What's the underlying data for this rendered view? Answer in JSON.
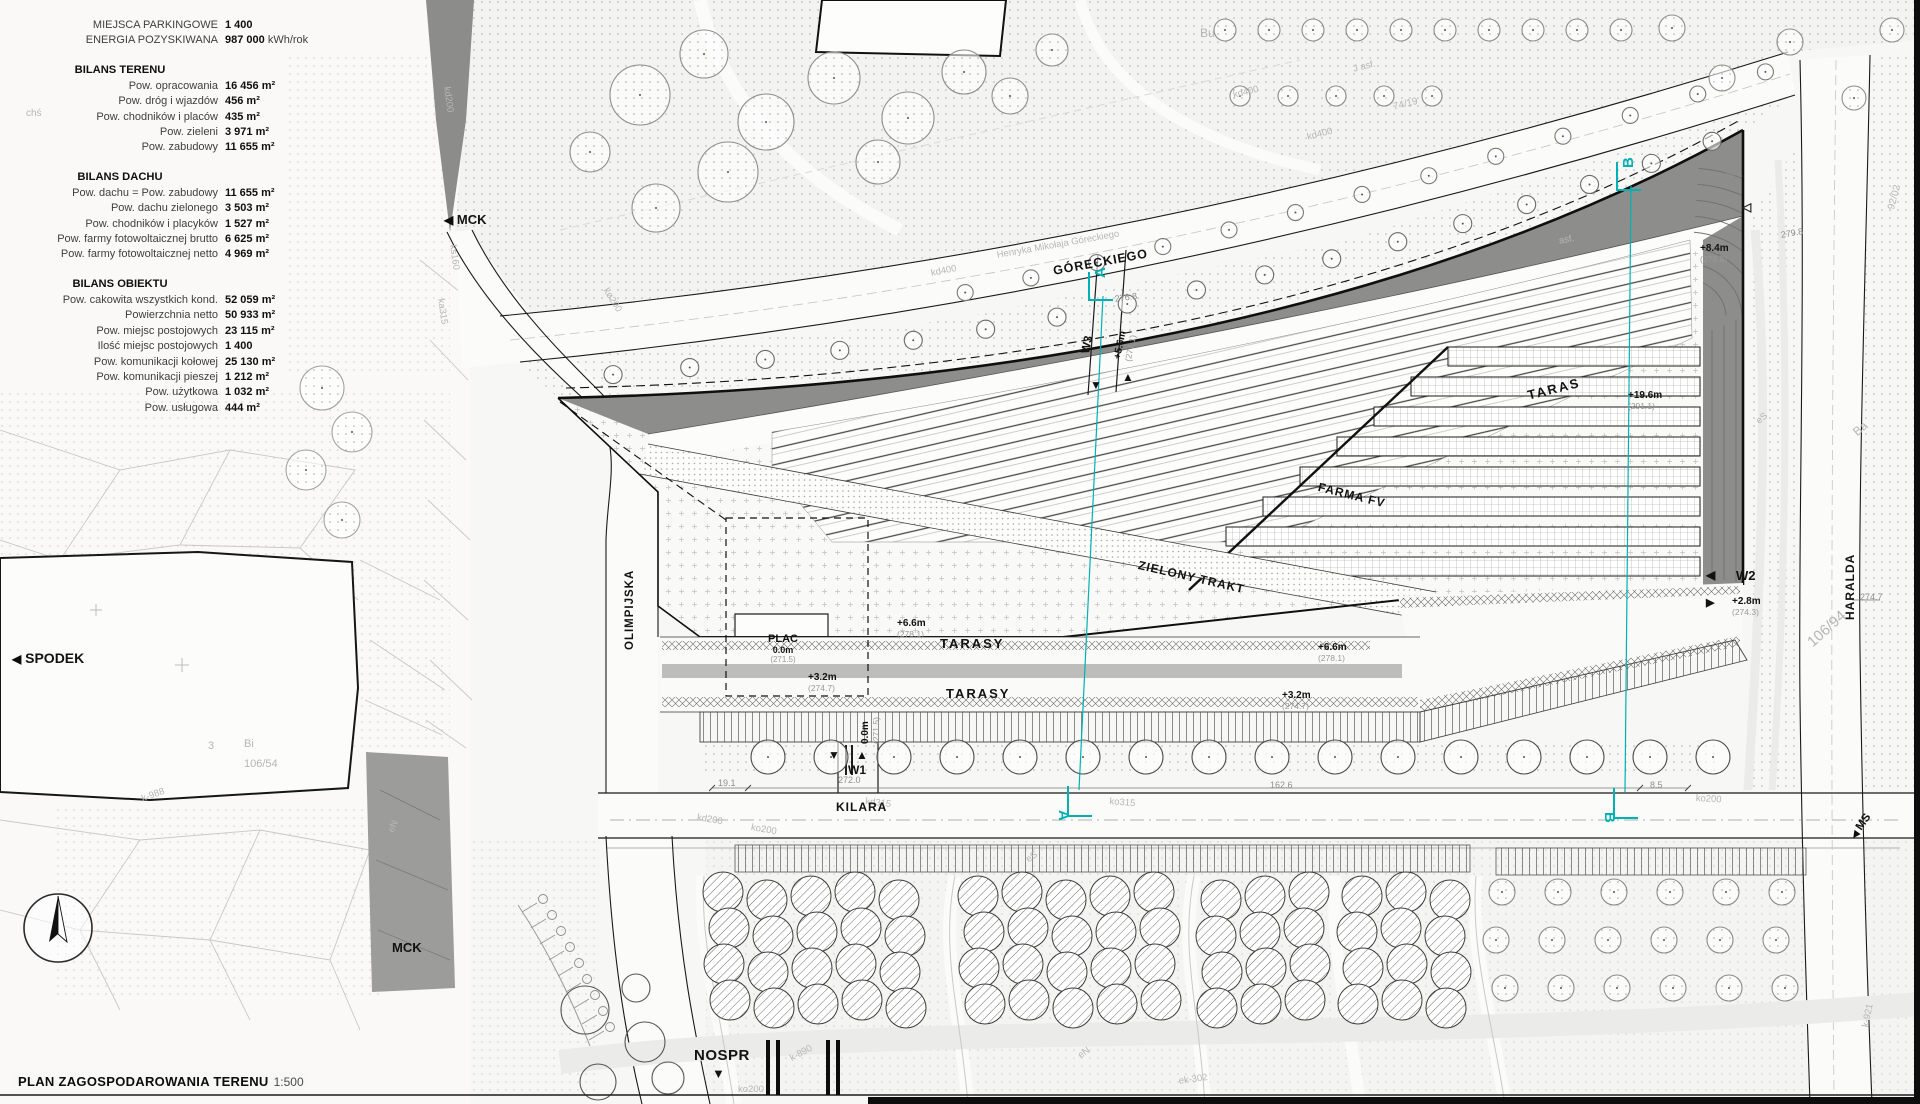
{
  "title": {
    "main": "PLAN ZAGOSPODAROWANIA TERENU",
    "scale": "1:500"
  },
  "stats": {
    "top_rows": [
      {
        "label": "MIEJSCA PARKINGOWE",
        "value": "1 400",
        "unit": ""
      },
      {
        "label": "ENERGIA POZYSKIWANA",
        "value": "987 000",
        "unit": " kWh/rok"
      }
    ],
    "sections": [
      {
        "title": "BILANS TERENU",
        "rows": [
          {
            "label": "Pow. opracowania",
            "value": "16 456 m²"
          },
          {
            "label": "Pow. dróg i wjazdów",
            "value": "456 m²"
          },
          {
            "label": "Pow. chodników i placów",
            "value": "435 m²"
          },
          {
            "label": "Pow. zieleni",
            "value": "3 971 m²"
          },
          {
            "label": "Pow. zabudowy",
            "value": "11 655 m²"
          }
        ]
      },
      {
        "title": "BILANS DACHU",
        "rows": [
          {
            "label": "Pow. dachu = Pow. zabudowy",
            "value": "11 655 m²"
          },
          {
            "label": "Pow. dachu zielonego",
            "value": "3 503 m²"
          },
          {
            "label": "Pow. chodników i placyków",
            "value": "1 527 m²"
          },
          {
            "label": "Pow. farmy fotowoltaicznej brutto",
            "value": "6 625 m²"
          },
          {
            "label": "Pow. farmy fotowoltaicznej netto",
            "value": "4 969 m²"
          }
        ]
      },
      {
        "title": "BILANS OBIEKTU",
        "rows": [
          {
            "label": "Pow. cakowita wszystkich kond.",
            "value": "52 059 m²"
          },
          {
            "label": "Powierzchnia netto",
            "value": "50 933 m²"
          },
          {
            "label": "Pow. miejsc postojowych",
            "value": "23 115 m²"
          },
          {
            "label": "Ilość miejsc postojowych",
            "value": "1 400"
          },
          {
            "label": "Pow. komunikacji kołowej",
            "value": "25 130 m²"
          },
          {
            "label": "Pow. komunikacji pieszej",
            "value": "1 212 m²"
          },
          {
            "label": "Pow. użytkowa",
            "value": "1 032 m²"
          },
          {
            "label": "Pow. usługowa",
            "value": "444 m²"
          }
        ]
      }
    ]
  },
  "landmarks": {
    "mck_top": "MCK",
    "spodek": "SPODEK",
    "mck_bottom": "MCK",
    "nospr": "NOSPR",
    "ms": "MS"
  },
  "streets": {
    "olimpijska": "OLIMPIJSKA",
    "kilara": "KILARA",
    "goreckiego": "GÓRECKIEGO",
    "haralda": "HARALDA",
    "goreckiego_full": "Henryka Mikołaja Góreckiego"
  },
  "zones": {
    "plac": "PLAC",
    "plac_level": "0.0m",
    "plac_abs": "(271.5)",
    "tarasy_upper": "TARASY",
    "tarasy_lower": "TARASY",
    "taras": "TARAS",
    "farma_fv": "FARMA FV",
    "zielony_trakt": "ZIELONY TRAKT"
  },
  "crossings": {
    "w1": "W1",
    "w2": "W2",
    "w3": "W3"
  },
  "section_marks": {
    "a": "A",
    "b": "B"
  },
  "elevations": [
    {
      "id": "w3",
      "level": "+5.6m",
      "abs": "(277.1)"
    },
    {
      "id": "e84",
      "level": "+8.4m",
      "abs": "(279.9)"
    },
    {
      "id": "e196",
      "level": "+19.6m",
      "abs": "(291.1)"
    },
    {
      "id": "e66l",
      "level": "+6.6m",
      "abs": "(278.1)"
    },
    {
      "id": "e66r",
      "level": "+6.6m",
      "abs": "(278.1)"
    },
    {
      "id": "e32l",
      "level": "+3.2m",
      "abs": "(274.7)"
    },
    {
      "id": "e32r",
      "level": "+3.2m",
      "abs": "(274.7)"
    },
    {
      "id": "e28",
      "level": "+2.8m",
      "abs": "(274.3)"
    },
    {
      "id": "w1",
      "level": "0.0m",
      "abs": "(271.5)"
    }
  ],
  "dim_texts": [
    {
      "t": "19.1",
      "x": 718,
      "y": 778,
      "r": 0
    },
    {
      "t": "272.0",
      "x": 838,
      "y": 775,
      "r": 0
    },
    {
      "t": "162.6",
      "x": 1270,
      "y": 780,
      "r": 0
    },
    {
      "t": "8.5",
      "x": 1650,
      "y": 780,
      "r": 0
    },
    {
      "t": "274.7",
      "x": 1860,
      "y": 592,
      "r": 0
    },
    {
      "t": "276.8",
      "x": 1114,
      "y": 294,
      "r": -8
    },
    {
      "t": "279.8",
      "x": 1780,
      "y": 230,
      "r": -10
    },
    {
      "t": "76.2",
      "x": 1724,
      "y": 172,
      "r": -12
    }
  ],
  "background_texts": [
    {
      "t": "kd400",
      "x": 1232,
      "y": 90,
      "r": -14,
      "s": 9.5
    },
    {
      "t": "kd400",
      "x": 1306,
      "y": 132,
      "r": -14,
      "s": 9.5
    },
    {
      "t": "74/19",
      "x": 1392,
      "y": 102,
      "r": -14,
      "s": 10
    },
    {
      "t": "J asf.",
      "x": 1352,
      "y": 64,
      "r": -14,
      "s": 9.5
    },
    {
      "t": "kd400",
      "x": 930,
      "y": 268,
      "r": -11,
      "s": 9.5
    },
    {
      "t": "asf.",
      "x": 1558,
      "y": 236,
      "r": -11,
      "s": 9.5
    },
    {
      "t": "Bu",
      "x": 1200,
      "y": 26,
      "r": 0,
      "s": 12
    },
    {
      "t": "chś",
      "x": 26,
      "y": 108,
      "r": 0,
      "s": 10
    },
    {
      "t": "kd200",
      "x": 452,
      "y": 86,
      "r": 82,
      "s": 9.5
    },
    {
      "t": "ks160",
      "x": 458,
      "y": 244,
      "r": 82,
      "s": 9.5
    },
    {
      "t": "ka315",
      "x": 446,
      "y": 298,
      "r": 82,
      "s": 9.5
    },
    {
      "t": "kø200",
      "x": 610,
      "y": 286,
      "r": 58,
      "s": 9.5
    },
    {
      "t": "3",
      "x": 208,
      "y": 740,
      "r": 0,
      "s": 11
    },
    {
      "t": "Bi",
      "x": 244,
      "y": 738,
      "r": 0,
      "s": 11
    },
    {
      "t": "106/54",
      "x": 244,
      "y": 758,
      "r": 0,
      "s": 11
    },
    {
      "t": "k-988",
      "x": 140,
      "y": 794,
      "r": -20,
      "s": 9.5
    },
    {
      "t": "eN",
      "x": 386,
      "y": 830,
      "r": -68,
      "s": 9.5
    },
    {
      "t": "kd315",
      "x": 866,
      "y": 796,
      "r": 7,
      "s": 9.5
    },
    {
      "t": "ko315",
      "x": 1110,
      "y": 796,
      "r": 5,
      "s": 9.5
    },
    {
      "t": "ko200",
      "x": 1696,
      "y": 793,
      "r": 3,
      "s": 9.5
    },
    {
      "t": "kd200",
      "x": 698,
      "y": 812,
      "r": 10,
      "s": 9.5
    },
    {
      "t": "ko200",
      "x": 752,
      "y": 822,
      "r": 10,
      "s": 9.5
    },
    {
      "t": "k-890",
      "x": 788,
      "y": 1054,
      "r": -28,
      "s": 9.5
    },
    {
      "t": "ko200",
      "x": 738,
      "y": 1084,
      "r": 0,
      "s": 9.5
    },
    {
      "t": "eN",
      "x": 1076,
      "y": 1052,
      "r": -35,
      "s": 9.5
    },
    {
      "t": "eS",
      "x": 1024,
      "y": 856,
      "r": -35,
      "s": 9.5
    },
    {
      "t": "ek-302",
      "x": 1178,
      "y": 1076,
      "r": -8,
      "s": 9.5
    },
    {
      "t": "k-921",
      "x": 1860,
      "y": 1026,
      "r": -78,
      "s": 9.5
    },
    {
      "t": "106/94",
      "x": 1804,
      "y": 638,
      "r": -42,
      "s": 15
    },
    {
      "t": "Ba",
      "x": 1850,
      "y": 428,
      "r": -40,
      "s": 12
    },
    {
      "t": "92/02",
      "x": 1886,
      "y": 208,
      "r": -75,
      "s": 10
    },
    {
      "t": "eS",
      "x": 1754,
      "y": 418,
      "r": -40,
      "s": 9.5
    }
  ],
  "icons": {
    "arrow_left": "◀",
    "arrow_right": "▶",
    "arrow_up": "▲",
    "arrow_down": "▼",
    "arrow_left_open": "◁"
  },
  "colors": {
    "accent_cyan": "#00b1b4",
    "dark_band": "#8d8d8b",
    "line": "#1a1a1a",
    "grey_text": "#9a9a98"
  }
}
